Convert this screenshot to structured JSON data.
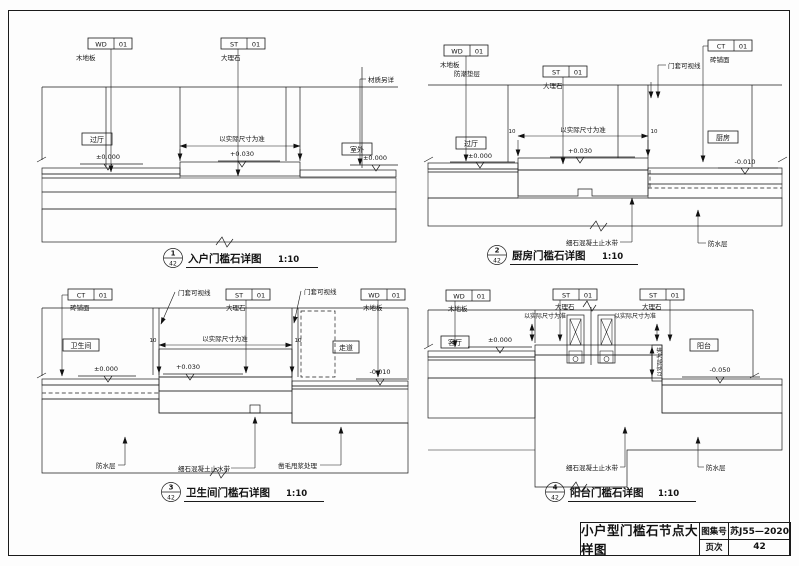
{
  "title_block": {
    "title": "小户型门槛石节点大样图",
    "atlas_label": "图集号",
    "atlas_value": "苏J55—2020",
    "page_label": "页次",
    "page_value": "42"
  },
  "details": {
    "d1": {
      "num": "1",
      "sheet": "42",
      "title": "入户门槛石详图",
      "scale": "1:10",
      "tag_wd": {
        "code": "WD",
        "num": "01",
        "label": "木地板"
      },
      "tag_st": {
        "code": "ST",
        "num": "01",
        "label": "大理石"
      },
      "note_material": "材质另详",
      "room_left": "过厅",
      "room_right": "室外",
      "elev_left": "±0.000",
      "elev_mid": "+0.030",
      "elev_right": "±0.000",
      "dim_note": "以实际尺寸为准"
    },
    "d2": {
      "num": "2",
      "sheet": "42",
      "title": "厨房门槛石详图",
      "scale": "1:10",
      "tag_wd": {
        "code": "WD",
        "num": "01",
        "label": "木地板",
        "sub": "防潮垫层"
      },
      "tag_st": {
        "code": "ST",
        "num": "01",
        "label": "大理石"
      },
      "tag_ct": {
        "code": "CT",
        "num": "01",
        "label": "砖铺面"
      },
      "note_door": "门套可视线",
      "room_left": "过厅",
      "room_right": "厨房",
      "elev_left": "±0.000",
      "elev_mid": "+0.030",
      "elev_right": "-0.010",
      "dim_note": "以实际尺寸为准",
      "dim_a": "10",
      "dim_b": "10",
      "note_waterstop": "细石混凝土止水带",
      "note_waterproof": "防水层"
    },
    "d3": {
      "num": "3",
      "sheet": "42",
      "title": "卫生间门槛石详图",
      "scale": "1:10",
      "tag_ct": {
        "code": "CT",
        "num": "01",
        "label": "砖铺面"
      },
      "tag_st": {
        "code": "ST",
        "num": "01",
        "label": "大理石"
      },
      "tag_wd": {
        "code": "WD",
        "num": "01",
        "label": "木地板"
      },
      "note_door_left": "门套可视线",
      "note_door_right": "门套可视线",
      "room_left": "卫生间",
      "room_right": "走道",
      "elev_left": "±0.000",
      "elev_mid": "+0.030",
      "elev_right": "-0.010",
      "dim_note": "以实际尺寸为准",
      "dim_a": "10",
      "dim_b": "10",
      "note_waterproof": "防水层",
      "note_waterstop": "细石混凝土止水带",
      "note_rough": "凿毛甩浆处理"
    },
    "d4": {
      "num": "4",
      "sheet": "42",
      "title": "阳台门槛石详图",
      "scale": "1:10",
      "tag_wd": {
        "code": "WD",
        "num": "01",
        "label": "木地板"
      },
      "tag_st1": {
        "code": "ST",
        "num": "01",
        "label": "大理石"
      },
      "tag_st2": {
        "code": "ST",
        "num": "01",
        "label": "大理石"
      },
      "dim_note_left": "以实际尺寸为准",
      "dim_note_right": "以实际尺寸为准",
      "dim_note_vertical": "以实际为准",
      "room_left": "客厅",
      "room_right": "阳台",
      "elev_left": "±0.000",
      "elev_right": "-0.050",
      "note_waterstop": "细石混凝土止水带",
      "note_waterproof": "防水层"
    }
  }
}
